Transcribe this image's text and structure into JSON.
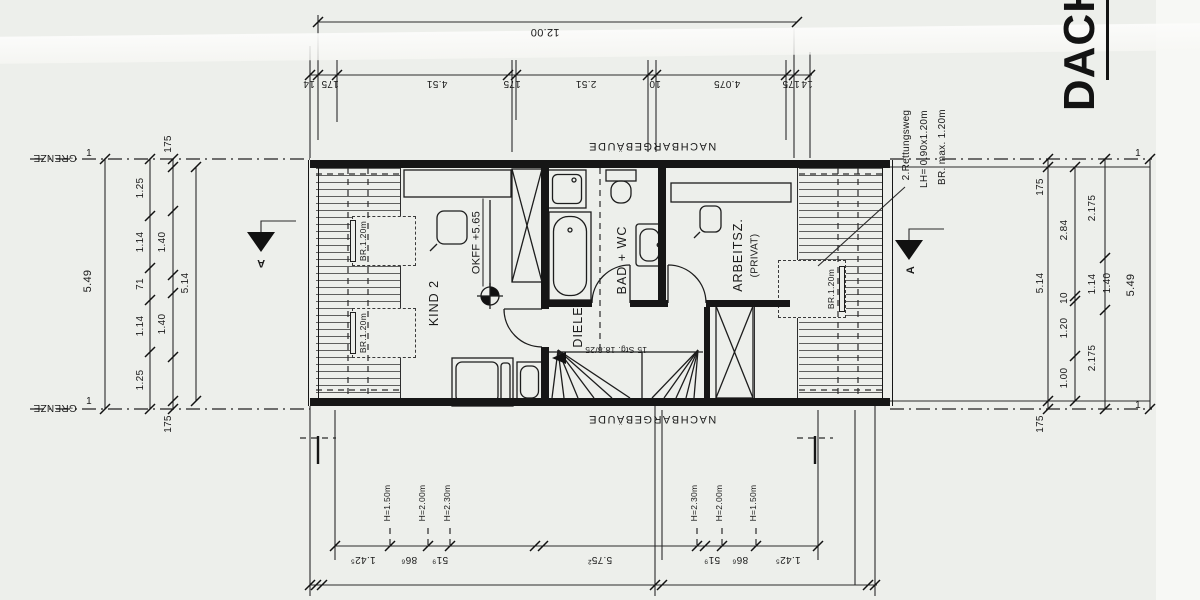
{
  "title": "DACHG",
  "site": {
    "grenze": "GRENZE",
    "neighbor": "NACHBARGEBÄUDE",
    "boundary_mark": "1"
  },
  "rooms": {
    "kind2": {
      "name": "KIND 2",
      "level": "OKFF +5.65"
    },
    "bad": {
      "name": "BAD + WC"
    },
    "diele": {
      "name": "DIELE"
    },
    "arbeitszimmer": {
      "name": "ARBEITSZ.",
      "qualifier": "(PRIVAT)"
    },
    "stairs": {
      "label": "15 Stg. 18.8/25"
    }
  },
  "dormers": {
    "width_label": "BR.1.20m"
  },
  "rescue_window": {
    "line1": "2.Rettungsweg",
    "line2": "LH= 0.90x1.20m",
    "line3": "BR. max. 1.20m"
  },
  "section": {
    "label": "A"
  },
  "roof_heights": {
    "h150": "H=1.50m",
    "h200": "H=2.00m",
    "h230": "H=2.30m"
  },
  "dimensions": {
    "top_total": "12.00",
    "top_chain": [
      "14",
      "175",
      "4.51",
      "175",
      "2.51",
      "10",
      "4.075",
      "175",
      "14"
    ],
    "bottom_chain": [
      "1.42⁵",
      "86⁶",
      "51⁹",
      "5.75²",
      "51⁹",
      "86⁶",
      "1.42⁵"
    ],
    "left": {
      "total": "5.49",
      "chain": [
        "1.25",
        "1.14",
        "71",
        "1.14",
        "1.25"
      ],
      "aux": [
        "175",
        "1.40",
        "1.40",
        "175"
      ],
      "inner_total": "5.14"
    },
    "right": {
      "total": "5.49",
      "chain": [
        "2.84",
        "10",
        "1.20",
        "1.00"
      ],
      "outer": [
        "2.175",
        "1.14",
        "2.175"
      ],
      "aux": "1.40",
      "wall": "175",
      "inner_total": "5.14"
    }
  }
}
